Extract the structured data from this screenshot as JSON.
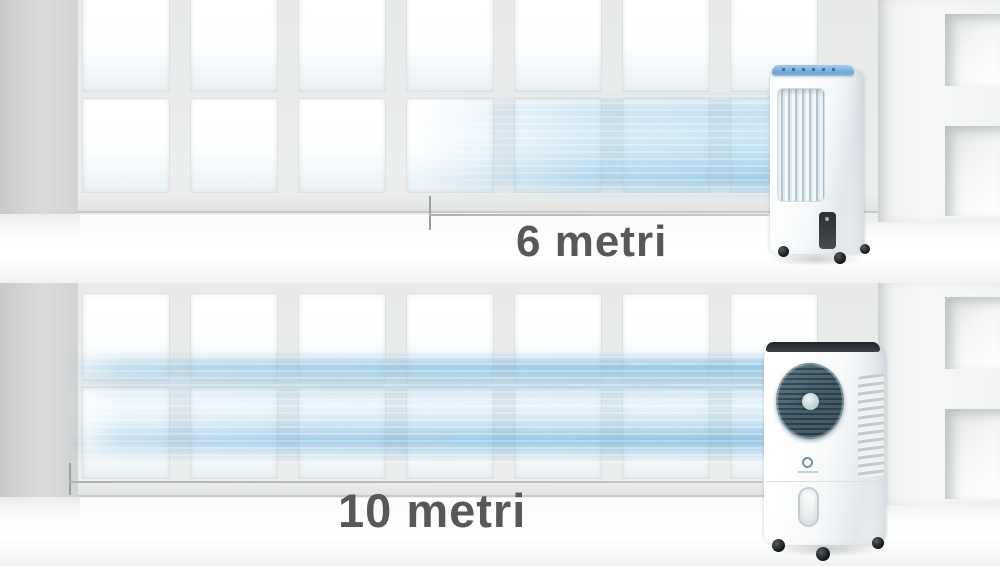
{
  "scenes": [
    {
      "id": "top",
      "distance_label": "6 metri",
      "device_name": "tower-evaporative-cooler"
    },
    {
      "id": "bottom",
      "distance_label": "10 metri",
      "device_name": "round-fan-evaporative-cooler"
    }
  ],
  "colors": {
    "airflow_blue": "#7db9dc",
    "label_text": "#57585a",
    "cooler_accent_blue": "#6ea6d6",
    "fan_face_teal": "#3d5663"
  }
}
